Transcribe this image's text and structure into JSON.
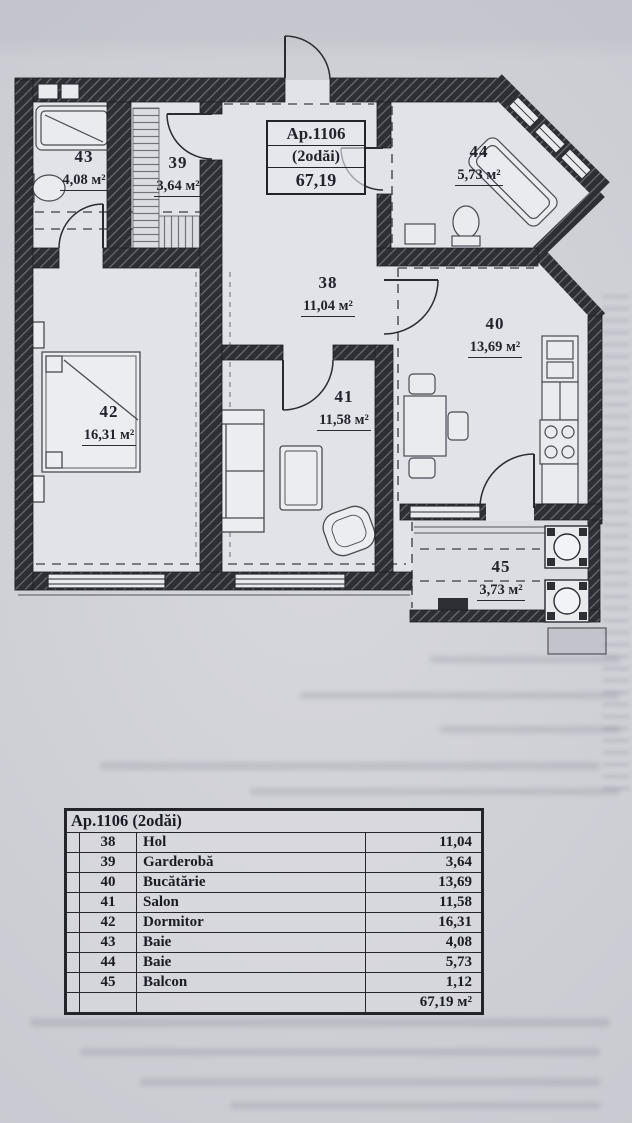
{
  "colors": {
    "paper": "#d3d4da",
    "floor": "#e2e3e8",
    "wall_dark": "#2e2e35",
    "ink": "#23232e"
  },
  "title_box": {
    "line1": "Ap.1106",
    "line2": "(2odăi)",
    "line3": "67,19"
  },
  "plan": {
    "rooms": [
      {
        "id": "38",
        "area": "11,04 м²"
      },
      {
        "id": "39",
        "area": "3,64 м²"
      },
      {
        "id": "40",
        "area": "13,69 м²"
      },
      {
        "id": "41",
        "area": "11,58 м²"
      },
      {
        "id": "42",
        "area": "16,31 м²"
      },
      {
        "id": "43",
        "area": "4,08 м²"
      },
      {
        "id": "44",
        "area": "5,73 м²"
      },
      {
        "id": "45",
        "area": "3,73 м²"
      }
    ]
  },
  "legend": {
    "header": "Ap.1106 (2odăi)",
    "rows": [
      {
        "num": "38",
        "name": "Hol",
        "area": "11,04"
      },
      {
        "num": "39",
        "name": "Garderobă",
        "area": "3,64"
      },
      {
        "num": "40",
        "name": "Bucătărie",
        "area": "13,69"
      },
      {
        "num": "41",
        "name": "Salon",
        "area": "11,58"
      },
      {
        "num": "42",
        "name": "Dormitor",
        "area": "16,31"
      },
      {
        "num": "43",
        "name": "Baie",
        "area": "4,08"
      },
      {
        "num": "44",
        "name": "Baie",
        "area": "5,73"
      },
      {
        "num": "45",
        "name": "Balcon",
        "area": "1,12"
      }
    ],
    "total": "67,19 м²"
  }
}
